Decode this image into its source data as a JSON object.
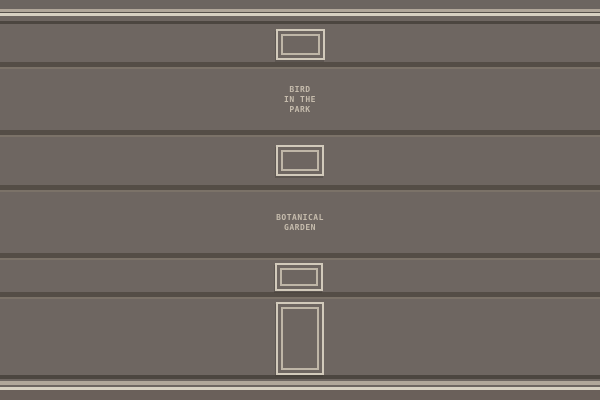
{
  "scene": {
    "name": "gallery-wall",
    "labels": {
      "bird": {
        "lines": [
          "BIRD",
          "IN THE",
          "PARK"
        ]
      },
      "botanical": {
        "lines": [
          "BOTANICAL",
          "GARDEN"
        ]
      }
    },
    "frames": [
      {
        "kind": "landscape-frame-small"
      },
      {
        "kind": "landscape-frame-small"
      },
      {
        "kind": "landscape-frame-mini"
      },
      {
        "kind": "portrait-frame"
      }
    ]
  },
  "colors": {
    "wall": "#6e6661",
    "wall_top": "#6c6560",
    "wall_bottom": "#6a605a",
    "stripe_beige": "#b1a79a",
    "stripe_cream": "#d8d1c2",
    "line_dark": "#4c4640",
    "line_dark_soft": "#57514b",
    "separator_dark": "#544d46",
    "separator_highlight": "#7b7268",
    "frame_border": "#d2cabb",
    "frame_border_inner": "#bfb6a7",
    "label_text": "#c6bcad"
  }
}
